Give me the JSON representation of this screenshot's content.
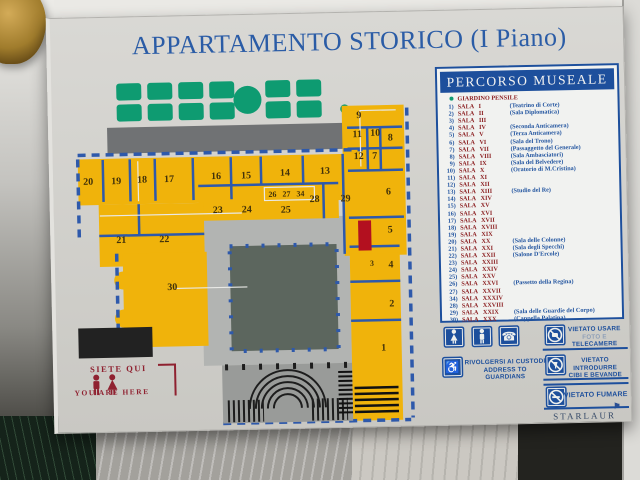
{
  "title": "APPARTAMENTO STORICO (I Piano)",
  "legend": {
    "header": "PERCORSO MUSEALE",
    "garden_label": "GIARDINO PENSILE",
    "sala_word": "SALA",
    "rooms": [
      {
        "num": "1)",
        "roman": "I",
        "desc": "(Teatrino di Corte)"
      },
      {
        "num": "2)",
        "roman": "II",
        "desc": "(Sala Diplomatica)"
      },
      {
        "num": "3)",
        "roman": "III",
        "desc": ""
      },
      {
        "num": "4)",
        "roman": "IV",
        "desc": "(Seconda Anticamera)"
      },
      {
        "num": "5)",
        "roman": "V",
        "desc": "(Terza Anticamera)"
      },
      {
        "num": "6)",
        "roman": "VI",
        "desc": "(Sala del Trono)"
      },
      {
        "num": "7)",
        "roman": "VII",
        "desc": "(Passaggetto del Generale)"
      },
      {
        "num": "8)",
        "roman": "VIII",
        "desc": "(Sala Ambasciatori)"
      },
      {
        "num": "9)",
        "roman": "IX",
        "desc": "(Sala del Belvedere)"
      },
      {
        "num": "10)",
        "roman": "X",
        "desc": "(Oratorio di M.Cristina)"
      },
      {
        "num": "11)",
        "roman": "XI",
        "desc": ""
      },
      {
        "num": "12)",
        "roman": "XII",
        "desc": ""
      },
      {
        "num": "13)",
        "roman": "XIII",
        "desc": "(Studio del Re)"
      },
      {
        "num": "14)",
        "roman": "XIV",
        "desc": ""
      },
      {
        "num": "15)",
        "roman": "XV",
        "desc": ""
      },
      {
        "num": "16)",
        "roman": "XVI",
        "desc": ""
      },
      {
        "num": "17)",
        "roman": "XVII",
        "desc": ""
      },
      {
        "num": "18)",
        "roman": "XVIII",
        "desc": ""
      },
      {
        "num": "19)",
        "roman": "XIX",
        "desc": ""
      },
      {
        "num": "20)",
        "roman": "XX",
        "desc": "(Sala delle Colonne)"
      },
      {
        "num": "21)",
        "roman": "XXI",
        "desc": "(Sala degli Specchi)"
      },
      {
        "num": "22)",
        "roman": "XXII",
        "desc": "(Salone D'Ercole)"
      },
      {
        "num": "23)",
        "roman": "XXIII",
        "desc": ""
      },
      {
        "num": "24)",
        "roman": "XXIV",
        "desc": ""
      },
      {
        "num": "25)",
        "roman": "XXV",
        "desc": ""
      },
      {
        "num": "26)",
        "roman": "XXVI",
        "desc": "(Passetto della Regina)"
      },
      {
        "num": "27)",
        "roman": "XXVII",
        "desc": ""
      },
      {
        "num": "34)",
        "roman": "XXXIV",
        "desc": ""
      },
      {
        "num": "28)",
        "roman": "XXVIII",
        "desc": ""
      },
      {
        "num": "29)",
        "roman": "XXIX",
        "desc": "(Sala delle Guardie del Corpo)"
      },
      {
        "num": "30)",
        "roman": "XXX",
        "desc": "(Cappella Palatina)"
      }
    ]
  },
  "map": {
    "room_labels": [
      {
        "n": "20",
        "x": 25,
        "y": 106
      },
      {
        "n": "19",
        "x": 53,
        "y": 106
      },
      {
        "n": "18",
        "x": 79,
        "y": 105
      },
      {
        "n": "17",
        "x": 106,
        "y": 105
      },
      {
        "n": "16",
        "x": 153,
        "y": 103
      },
      {
        "n": "15",
        "x": 183,
        "y": 103
      },
      {
        "n": "14",
        "x": 222,
        "y": 101
      },
      {
        "n": "13",
        "x": 262,
        "y": 100
      },
      {
        "n": "12",
        "x": 296,
        "y": 86
      },
      {
        "n": "7",
        "x": 312,
        "y": 86
      },
      {
        "n": "9",
        "x": 297,
        "y": 45
      },
      {
        "n": "11",
        "x": 295,
        "y": 64
      },
      {
        "n": "10",
        "x": 313,
        "y": 63
      },
      {
        "n": "8",
        "x": 328,
        "y": 68
      },
      {
        "n": "26",
        "x": 209,
        "y": 122,
        "s": 8
      },
      {
        "n": "27",
        "x": 223,
        "y": 122,
        "s": 8
      },
      {
        "n": "34",
        "x": 237,
        "y": 122,
        "s": 8
      },
      {
        "n": "28",
        "x": 251,
        "y": 128
      },
      {
        "n": "29",
        "x": 282,
        "y": 128
      },
      {
        "n": "6",
        "x": 325,
        "y": 122
      },
      {
        "n": "25",
        "x": 222,
        "y": 138
      },
      {
        "n": "23",
        "x": 154,
        "y": 137
      },
      {
        "n": "24",
        "x": 183,
        "y": 137
      },
      {
        "n": "21",
        "x": 57,
        "y": 165
      },
      {
        "n": "22",
        "x": 100,
        "y": 165
      },
      {
        "n": "30",
        "x": 107,
        "y": 213
      },
      {
        "n": "5",
        "x": 326,
        "y": 160
      },
      {
        "n": "3",
        "x": 307,
        "y": 193,
        "s": 8
      },
      {
        "n": "4",
        "x": 326,
        "y": 195
      },
      {
        "n": "2",
        "x": 326,
        "y": 234
      },
      {
        "n": "1",
        "x": 317,
        "y": 278
      }
    ]
  },
  "you_are_here": {
    "line1": "SIETE QUI",
    "line2": "YOU ARE HERE"
  },
  "info_panel": {
    "wc_label": "WC",
    "guardians_line1": "RIVOLGERSI AI CUSTODI",
    "guardians_line2": "ADDRESS TO GUARDIANS",
    "no_camera_line1": "VIETATO USARE",
    "no_camera_line2a": "FOTO E",
    "no_camera_line2b": "TELECAMERE",
    "no_food_line1": "VIETATO INTRODURRE",
    "no_food_line2": "CIBI E BEVANDE",
    "no_smoking": "VIETATO FUMARE"
  },
  "icons": {
    "telephone_glyph": "☎",
    "wheelchair_glyph": "♿",
    "flag_glyph": "⚑"
  },
  "brand": "STARLAUR",
  "colors": {
    "blue": "#1d4f9c",
    "maroon": "#8c2022",
    "room_yellow": "#f0b30b",
    "garden_green": "#0e9b71",
    "marker_red": "#b3101f",
    "courtyard": "#5c665e"
  }
}
